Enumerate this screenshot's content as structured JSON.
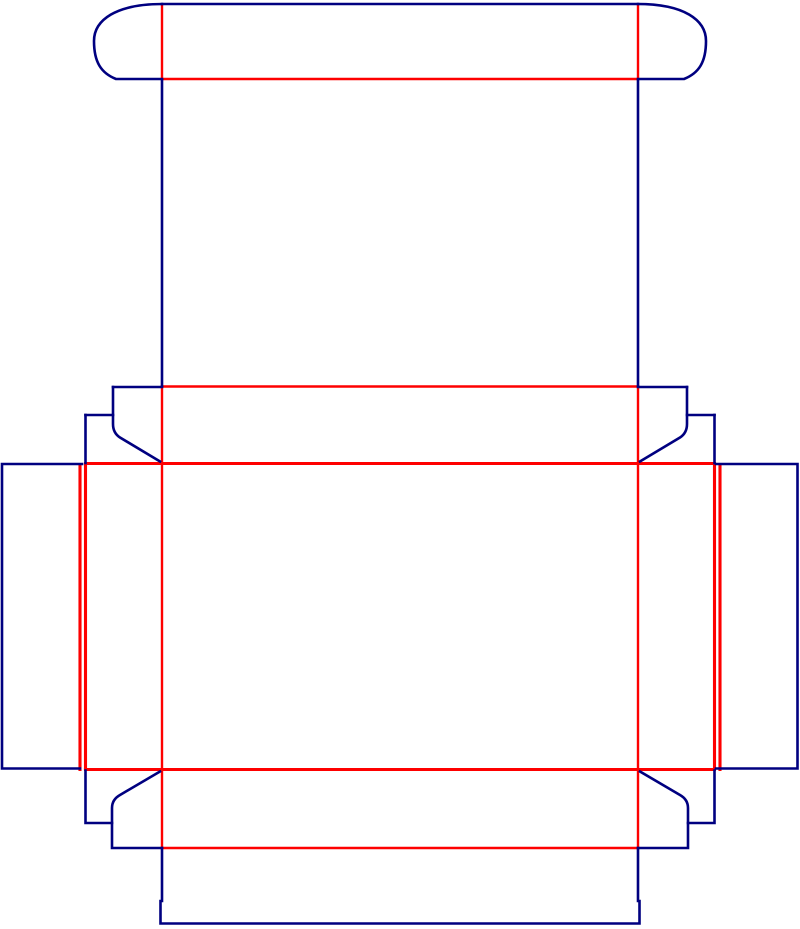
{
  "diagram": {
    "type": "packaging-dieline",
    "description": "folding-carton-box-dieline",
    "canvas": {
      "width": 800,
      "height": 929,
      "background": "#ffffff"
    },
    "colors": {
      "cut": "#000080",
      "crease": "#fe0000"
    },
    "stroke": {
      "cut": 2.6,
      "crease": 2.4,
      "heavy": 3.1
    },
    "crease_lines": [
      {
        "name": "tuck-flap-left-crease",
        "d": "M 162 5 L 162 79"
      },
      {
        "name": "tuck-flap-right-crease",
        "d": "M 638 5 L 638 79"
      },
      {
        "name": "tuck-flap-base-crease",
        "d": "M 162 79 L 638 79"
      },
      {
        "name": "top-flap-row-crease",
        "d": "M 162 386.5 L 638 386.5"
      },
      {
        "name": "left-panel-crease",
        "d": "M 162 386.5 L 162 848"
      },
      {
        "name": "right-panel-crease",
        "d": "M 638 386.5 L 638 848"
      },
      {
        "name": "main-panel-top-crease",
        "d": "M 85.5 463.5 L 714.5 463.5",
        "heavy": true
      },
      {
        "name": "main-panel-bottom-crease",
        "d": "M 85.5 769.5 L 714.5 769.5",
        "heavy": true
      },
      {
        "name": "left-edge-outer-crease",
        "d": "M 80 464.5 L 80 769.5",
        "heavy": true
      },
      {
        "name": "left-edge-main-crease",
        "d": "M 85.5 465 L 85.5 768.5",
        "heavy": true
      },
      {
        "name": "right-edge-main-crease",
        "d": "M 714.5 465 L 714.5 768.5",
        "heavy": true
      },
      {
        "name": "right-edge-outer-crease",
        "d": "M 720 464.5 L 720 769.5",
        "heavy": true
      },
      {
        "name": "bottom-flap-row-crease",
        "d": "M 162 848 L 638 848"
      }
    ],
    "cut_lines": [
      {
        "name": "tuck-flap-top-edge",
        "d": "M 162 4 L 638 4"
      },
      {
        "name": "tuck-flap-left-cap",
        "d": "M 162 4 C 116 4 94 20 94 41 C 94 62 101 73 116 79 L 162 79"
      },
      {
        "name": "tuck-flap-right-cap",
        "d": "M 638 4 C 684 4 706 20 706 41 C 706 62 699 73 684 79 L 638 79"
      },
      {
        "name": "top-panel-left-edge",
        "d": "M 162 80 L 162 386"
      },
      {
        "name": "top-panel-right-edge",
        "d": "M 638 80 L 638 386"
      },
      {
        "name": "top-left-shoulder-edge",
        "d": "M 113 387 L 162 387"
      },
      {
        "name": "top-left-shoulder-chamfer",
        "d": "M 113 387 L 113 424 Q 113 433 120 437.5 L 160 461.5"
      },
      {
        "name": "top-left-step-edge",
        "d": "M 85.5 415 L 113 415"
      },
      {
        "name": "top-left-step-vertical",
        "d": "M 85.5 415 L 85.5 463"
      },
      {
        "name": "top-right-shoulder-edge",
        "d": "M 638 387 L 687 387"
      },
      {
        "name": "top-right-shoulder-chamfer",
        "d": "M 687 387 L 687 424 Q 687 433 680 437.5 L 640 461.5"
      },
      {
        "name": "top-right-step-edge",
        "d": "M 687 415 L 714.5 415"
      },
      {
        "name": "top-right-step-vertical",
        "d": "M 714.5 415 L 714.5 463"
      },
      {
        "name": "left-flap-outline",
        "d": "M 82 464 L 2 464 L 2 768.5 L 80 768.5"
      },
      {
        "name": "right-flap-outline",
        "d": "M 716 464 L 797.5 464 L 797.5 768.5 L 716 768.5"
      },
      {
        "name": "bottom-left-step",
        "d": "M 85.5 770.5 L 85.5 823 L 112 823"
      },
      {
        "name": "bottom-left-shoulder-chamfer",
        "d": "M 160 771.5 L 120 795 Q 112 799.5 112 808 L 112 848 L 162 848"
      },
      {
        "name": "bottom-right-step",
        "d": "M 714.5 770.5 L 714.5 823 L 688 823"
      },
      {
        "name": "bottom-right-shoulder-chamfer",
        "d": "M 640 771.5 L 680 795 Q 688 799.5 688 808 L 688 848 L 638 848"
      },
      {
        "name": "bottom-tuck-outline",
        "d": "M 162 848 L 162 901 L 160.5 901 L 160.5 923.5 L 639.5 923.5 L 639.5 901 L 638 901 L 638 848"
      }
    ]
  }
}
